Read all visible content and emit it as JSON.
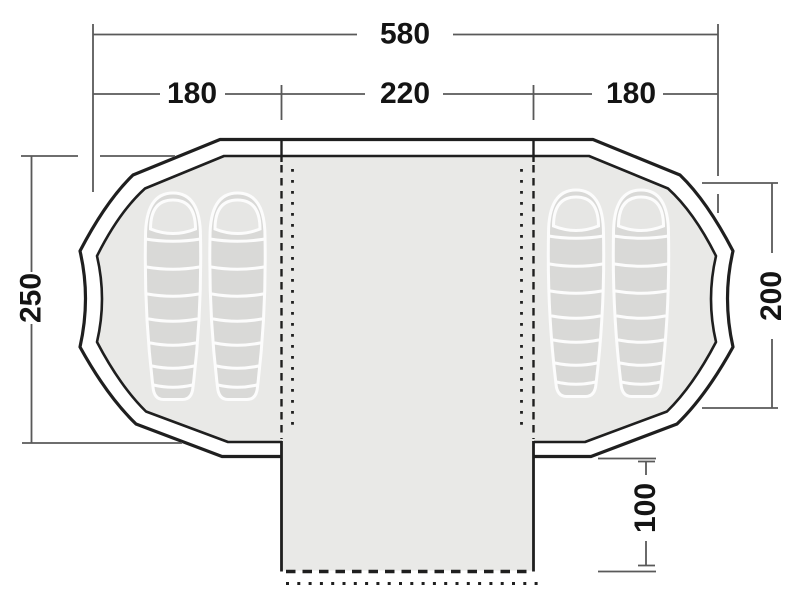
{
  "diagram": {
    "type": "tent-floorplan-top-view",
    "colors": {
      "outline": "#1f1f1f",
      "floor-fill": "#e9e9e7",
      "bag-fill": "#d9d9d7",
      "bag-hood-fill": "#e6e6e4",
      "bag-seam": "#fcfcfc",
      "dim-line": "#595959",
      "dim-text": "#141414"
    },
    "dimensions": {
      "overall_width": "580",
      "left_cabin_width": "180",
      "center_section_width": "220",
      "right_cabin_width": "180",
      "overall_depth": "250",
      "right_cabin_depth": "200",
      "front_extension_depth": "100"
    },
    "features": {
      "sleeping_bags_left": 2,
      "sleeping_bags_right": 2,
      "front_extension": "open front edge shown dashed and dotted",
      "inner_dividers": "dashed and dotted vertical lines between cabins and center section"
    }
  }
}
